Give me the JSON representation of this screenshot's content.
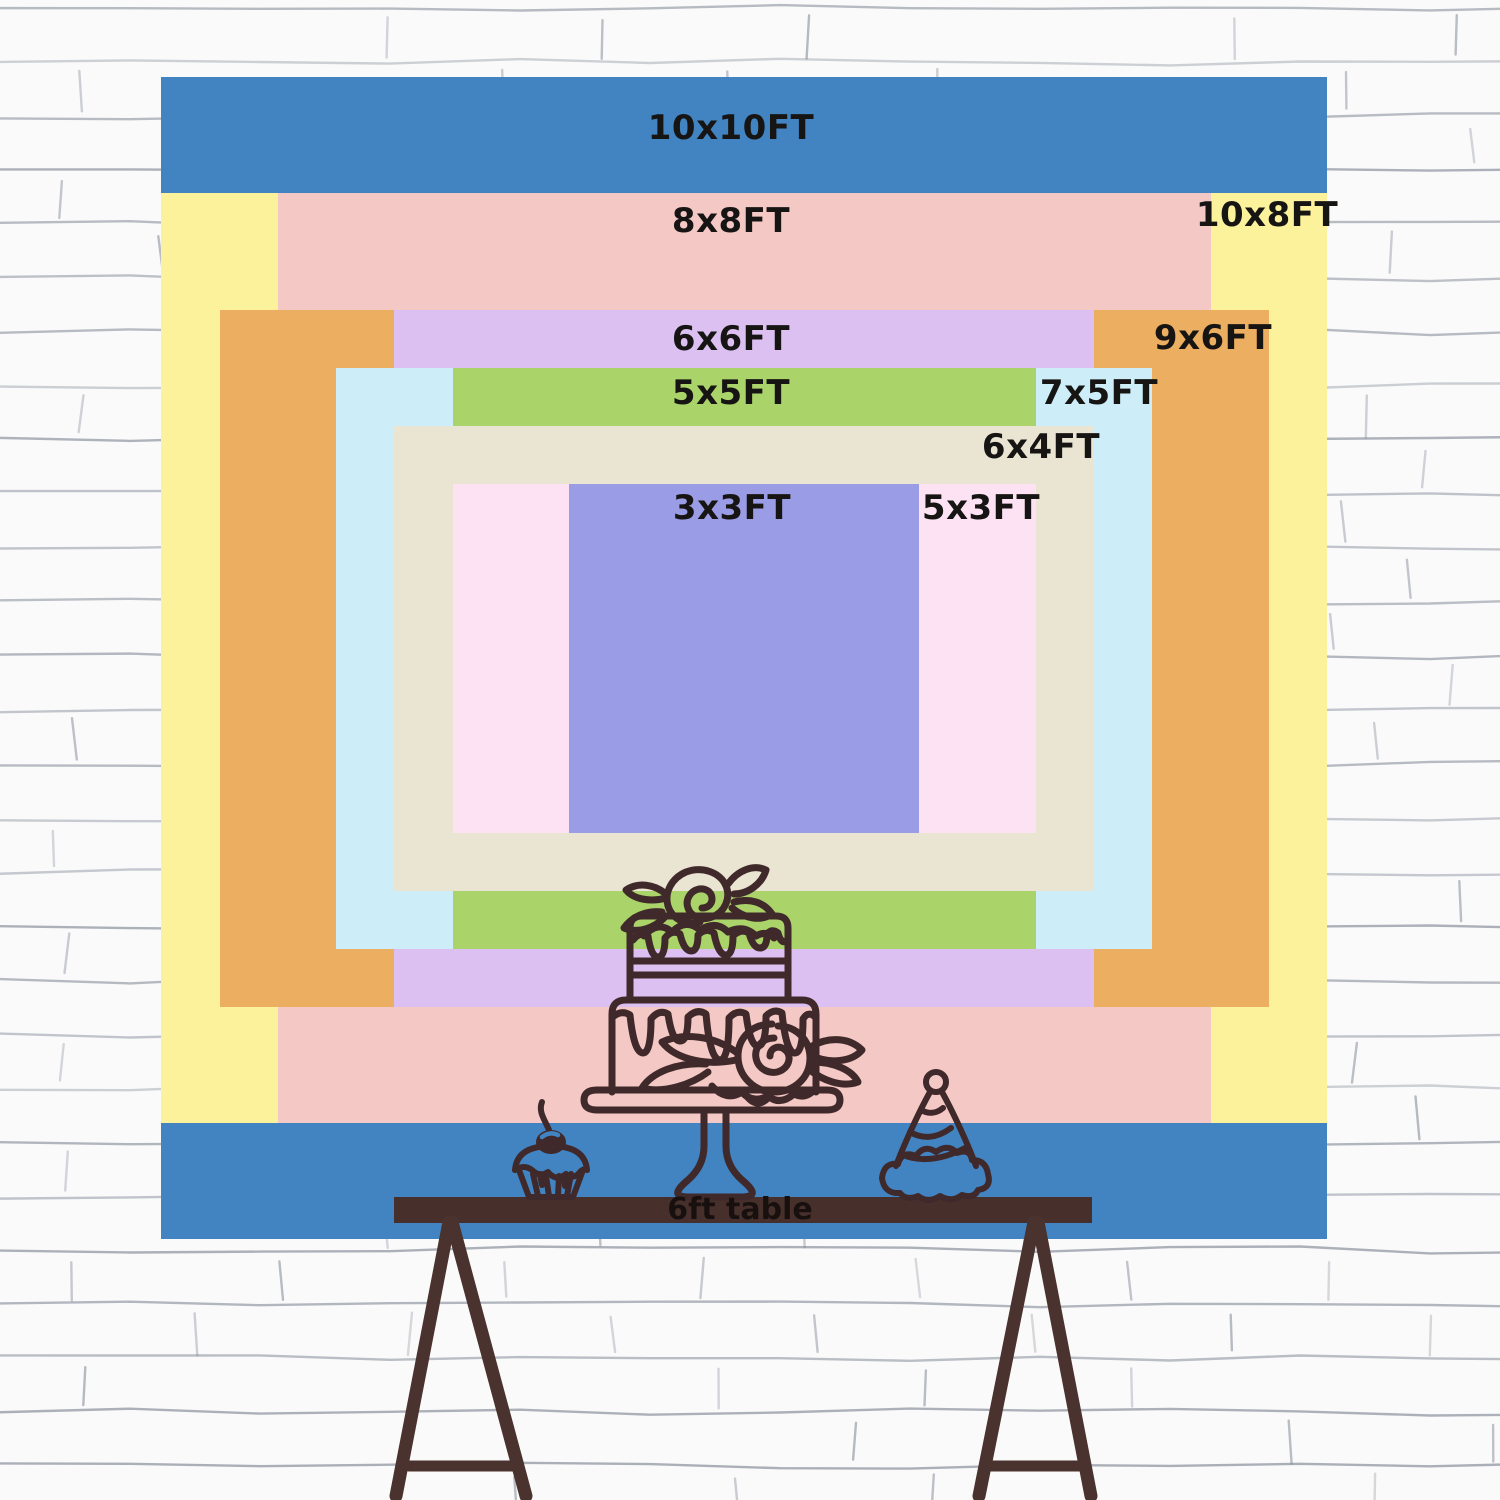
{
  "backdrop": {
    "unit": "FT",
    "px_per_ft_x": 116.6,
    "px_per_ft_y": 116.2,
    "center_x": 744,
    "center_y": 658,
    "sizes": [
      {
        "label": "10x10FT",
        "w_ft": 10,
        "h_ft": 10,
        "color": "#4284c2",
        "label_x": 731,
        "label_y": 128
      },
      {
        "label": "10x8FT",
        "w_ft": 10,
        "h_ft": 8,
        "color": "#fbf29b",
        "label_x": 1267,
        "label_y": 215
      },
      {
        "label": "8x8FT",
        "w_ft": 8,
        "h_ft": 8,
        "color": "#f4c8c5",
        "label_x": 731,
        "label_y": 221
      },
      {
        "label": "9x6FT",
        "w_ft": 9,
        "h_ft": 6,
        "color": "#ecae60",
        "label_x": 1213,
        "label_y": 338
      },
      {
        "label": "6x6FT",
        "w_ft": 6,
        "h_ft": 6,
        "color": "#dbc0f1",
        "label_x": 731,
        "label_y": 339
      },
      {
        "label": "7x5FT",
        "w_ft": 7,
        "h_ft": 5,
        "color": "#cdeef9",
        "label_x": 1099,
        "label_y": 393
      },
      {
        "label": "5x5FT",
        "w_ft": 5,
        "h_ft": 5,
        "color": "#aad369",
        "label_x": 731,
        "label_y": 393
      },
      {
        "label": "6x4FT",
        "w_ft": 6,
        "h_ft": 4,
        "color": "#eae5d3",
        "label_x": 1041,
        "label_y": 447
      },
      {
        "label": "5x3FT",
        "w_ft": 5,
        "h_ft": 3,
        "color": "#fde2f4",
        "label_x": 981,
        "label_y": 508
      },
      {
        "label": "3x3FT",
        "w_ft": 3,
        "h_ft": 3,
        "color": "#9b9ce6",
        "label_x": 732,
        "label_y": 508
      }
    ]
  },
  "table": {
    "label": "6ft table",
    "label_x": 740,
    "label_y": 1210,
    "top_color": "#47302b",
    "leg_color": "#4a322e",
    "text_color": "#17100f"
  },
  "illustrations": {
    "outline_color": "#40292a",
    "cherry_highlight_color": "#4284c2",
    "items": [
      "birthday-cake",
      "cupcake",
      "party-hat"
    ]
  },
  "wall": {
    "background": "#fafafa",
    "line_color": "#848b98"
  }
}
